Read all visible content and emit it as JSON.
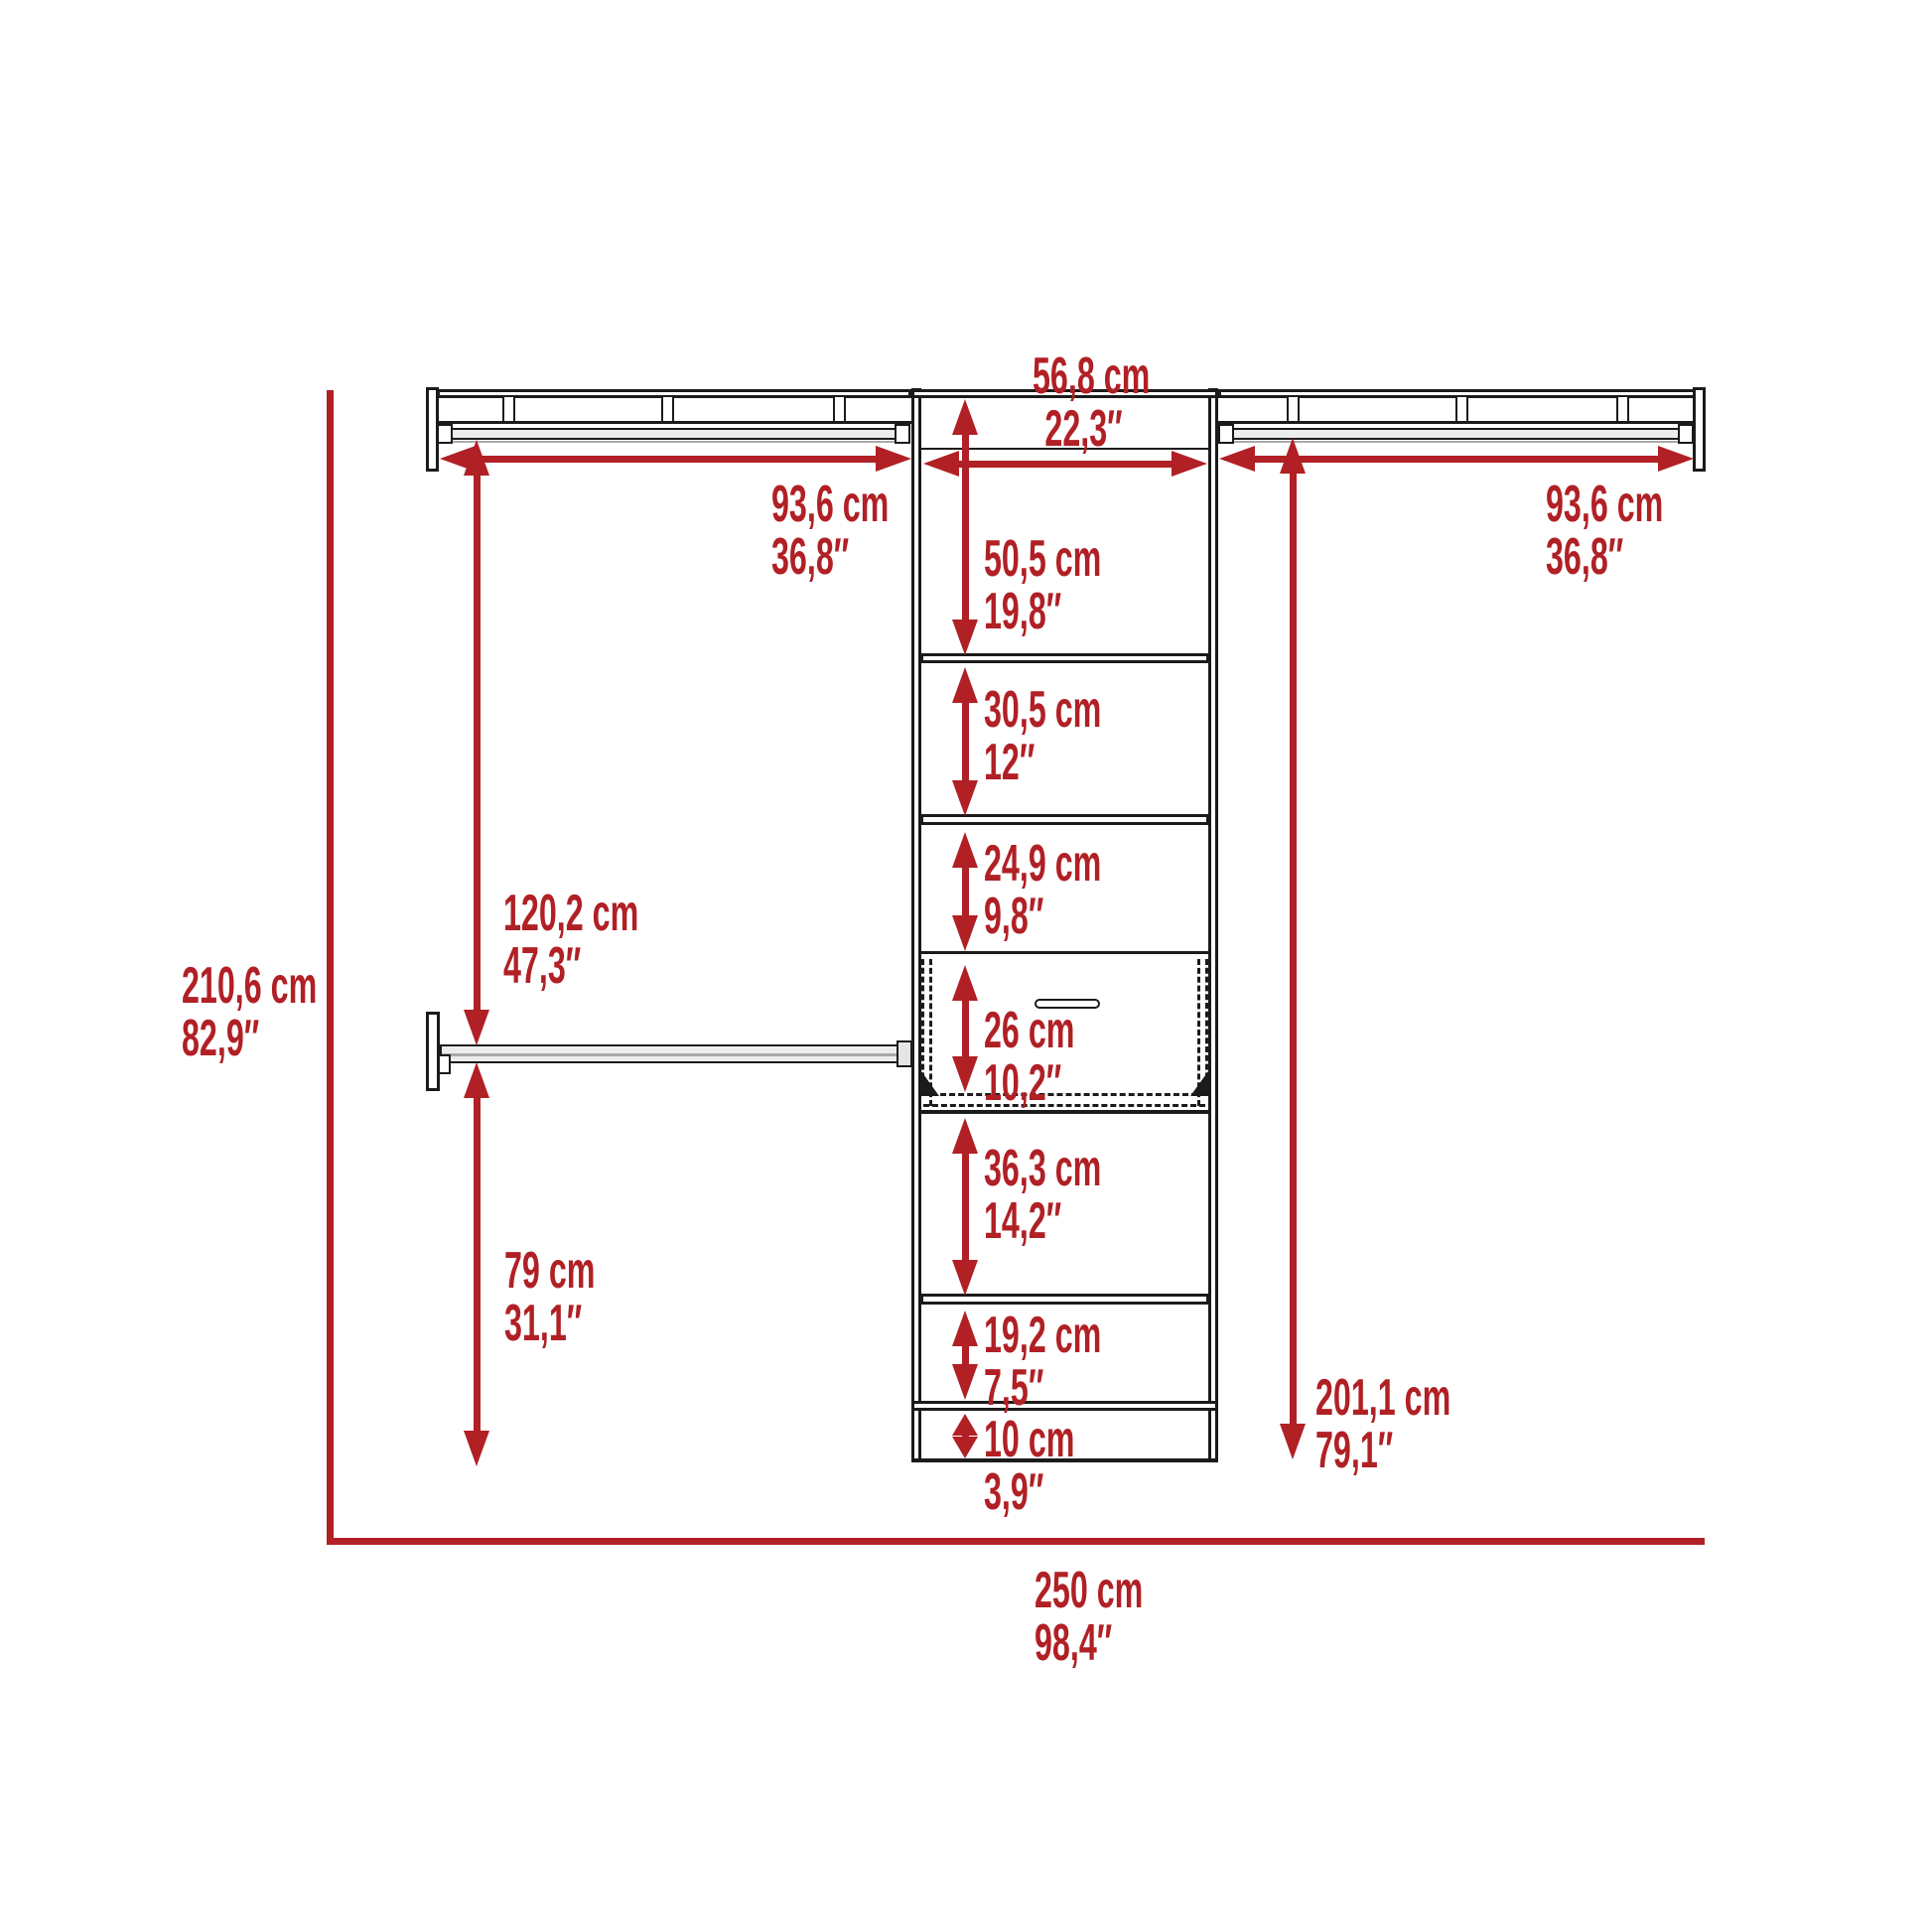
{
  "colors": {
    "dimension_red": "#b02025",
    "line_black": "#1b1b1b",
    "background": "#ffffff"
  },
  "dimensions": {
    "tower_width": {
      "cm": "56,8 cm",
      "inch": "22,3″"
    },
    "left_shelf_width": {
      "cm": "93,6 cm",
      "inch": "36,8″"
    },
    "right_shelf_width": {
      "cm": "93,6 cm",
      "inch": "36,8″"
    },
    "tower_sections": [
      {
        "cm": "50,5 cm",
        "inch": "19,8″"
      },
      {
        "cm": "30,5 cm",
        "inch": "12″"
      },
      {
        "cm": "24,9 cm",
        "inch": "9,8″"
      },
      {
        "cm": "26 cm",
        "inch": "10,2″"
      },
      {
        "cm": "36,3 cm",
        "inch": "14,2″"
      },
      {
        "cm": "19,2 cm",
        "inch": "7,5″"
      },
      {
        "cm": "10 cm",
        "inch": "3,9″"
      }
    ],
    "upper_rod_to_lower_rod": {
      "cm": "120,2 cm",
      "inch": "47,3″"
    },
    "total_height": {
      "cm": "210,6 cm",
      "inch": "82,9″"
    },
    "lower_rod_to_floor": {
      "cm": "79 cm",
      "inch": "31,1″"
    },
    "right_rod_height": {
      "cm": "201,1 cm",
      "inch": "79,1″"
    },
    "total_width": {
      "cm": "250 cm",
      "inch": "98,4″"
    }
  }
}
